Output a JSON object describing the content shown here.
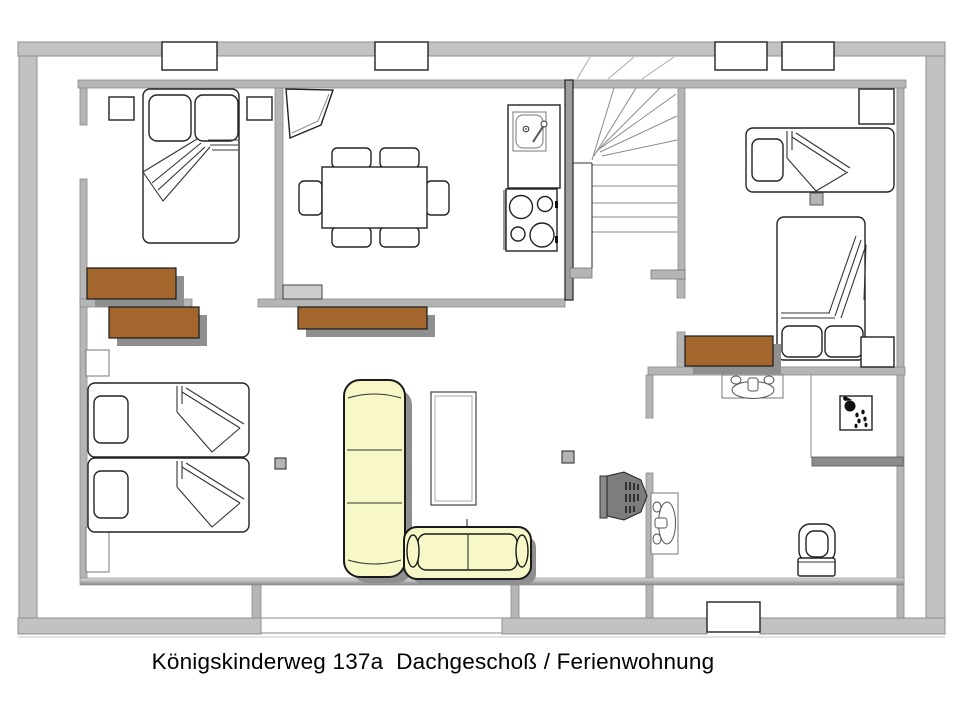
{
  "caption": "Königskinderweg 137a  Dachgeschoß / Ferienwohnung",
  "colors": {
    "background": "#ffffff",
    "outer-wall": "#c2c2c2",
    "inner-wall": "#b5b5b5",
    "dark-wall": "#9e9e9e",
    "wood": "#a3672e",
    "sofa": "#f7f7c8",
    "shadow": "#8f8f8f",
    "outline": "#222222",
    "radiator": "#cccccc"
  }
}
